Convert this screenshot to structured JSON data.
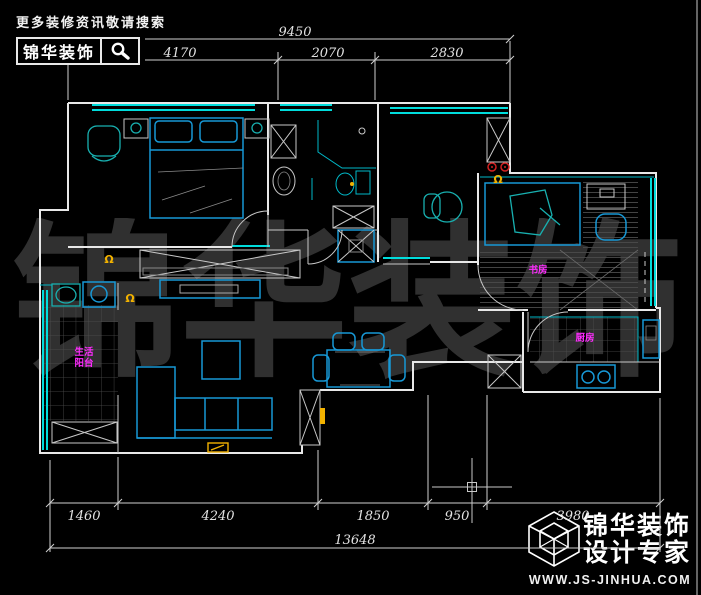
{
  "header": {
    "search_hint": "更多装修资讯敬请搜索",
    "brand": "锦华装饰",
    "icon": "magnifier-icon"
  },
  "watermark": {
    "text": "锦华装饰"
  },
  "dimensions": {
    "top": {
      "total": "9450",
      "segments": [
        "4170",
        "2070",
        "2830"
      ]
    },
    "bottom": {
      "segments": [
        "1460",
        "4240",
        "1850",
        "950",
        "3980"
      ],
      "total": "13648"
    }
  },
  "room_labels": {
    "balcony_line1": "生活",
    "balcony_line2": "阳台",
    "study": "书房",
    "kitchen": "厨房"
  },
  "footer": {
    "brand_line1": "锦华装饰",
    "brand_line2": "设计专家",
    "website": "WWW.JS-JINHUA.COM",
    "icon": "cube-logo-icon"
  },
  "colors": {
    "wall": "#e8e8e8",
    "window": "#00dcdc",
    "furniture": "#1798d6",
    "teal": "#18b0b0",
    "label": "#ff2bff",
    "tag": "#f2b200",
    "alert": "#d22222"
  }
}
